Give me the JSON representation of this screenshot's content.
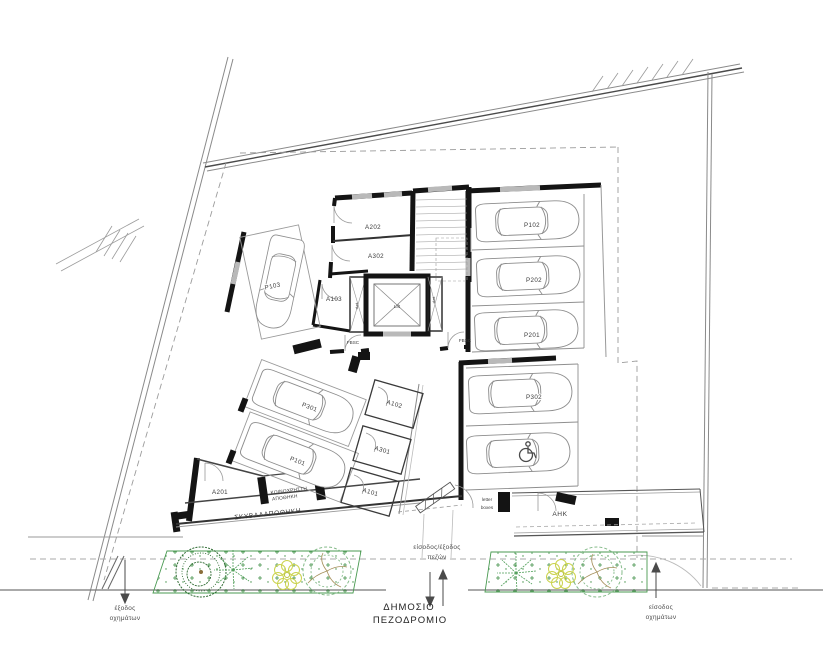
{
  "labels": {
    "a202": "A202",
    "a302": "A302",
    "a103": "A103",
    "a102": "A102",
    "a301": "A301",
    "a101": "A101",
    "a201": "A201",
    "p103": "P103",
    "p102": "P102",
    "p202": "P202",
    "p201": "P201",
    "p301": "P301",
    "p101": "P101",
    "p302": "P302",
    "lift": "Lift",
    "duct_left": "duct",
    "duct_right": "duct",
    "fbsc_left": "FBSC",
    "fbsc_right": "FBSC",
    "communal_storage_1": "ΚΟΙΝΟΧΡΗΣΤΗ",
    "communal_storage_2": "ΑΠΟΘΗΚΗ",
    "garbage_storage": "ΣΚΥΒΑΛΑΠΟΘΗΚΗ",
    "electricity_room": "ΑΗΚ",
    "letter_boxes_1": "letter",
    "letter_boxes_2": "boxes",
    "vehicle_exit_1": "έξοδος",
    "vehicle_exit_2": "οχημάτων",
    "pedestrian_1": "είσοδος/έξοδος",
    "pedestrian_2": "πεζών",
    "public_sidewalk_1": "ΔΗΜΟΣΙΟ",
    "public_sidewalk_2": "ΠΕΖΟΔΡΟΜΙΟ",
    "vehicle_entry_1": "είσοδος",
    "vehicle_entry_2": "οχημάτων"
  },
  "colors": {
    "wall": "#141414",
    "thin_line": "#777777",
    "window_hatch": "#b9b9b9",
    "green_dark": "#2d6a31",
    "green_light": "#85bb8a",
    "yellow_green": "#cbd34d"
  }
}
